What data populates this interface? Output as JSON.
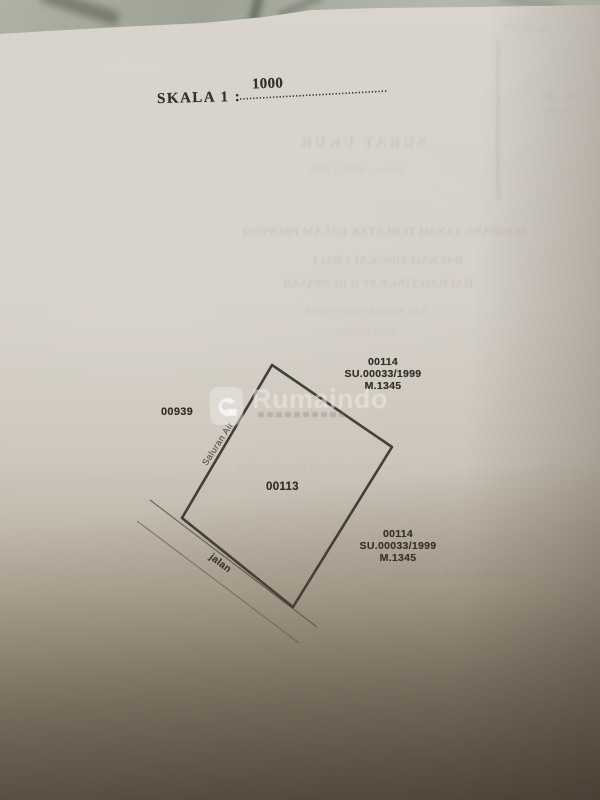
{
  "photo": {
    "surface": "marble-table",
    "colors": {
      "marble": "#a6aa9c",
      "paper_top": "#d8d4cd",
      "paper_bottom": "#6f6557",
      "ink": "#343028",
      "ghost_ink": "#7e756a",
      "watermark": "#f0ede8"
    }
  },
  "scale": {
    "label": "SKALA 1 :",
    "value": "1000"
  },
  "plan": {
    "parcel_number": "00113",
    "neighbor_left": "00939",
    "neighbor_top_right": {
      "l1": "00114",
      "l2": "SU.00033/1999",
      "l3": "M.1345"
    },
    "neighbor_bottom_right": {
      "l1": "00114",
      "l2": "SU.00033/1999",
      "l3": "M.1345"
    },
    "edge_labels": {
      "channel": "Saluran Air",
      "road": "jalan"
    }
  },
  "watermark": {
    "brand": "Rumaindo",
    "logo": "rumaindo-logo-icon"
  },
  "bleed_through_mirrored": {
    "g1": "SURAT UKUR",
    "g2": "Nomor : 00033 / 1999",
    "g3": "SEBIDANG TANAH TERLETAK DALAM PROPINSI",
    "g4": "DAERAH TINGKAT I BALI",
    "g5": "DAERAH TINGKAT II DENPASAR",
    "g6": "KECAMATAN DENPASAR",
    "g7": "KELURAHAN",
    "g8": "Sesuai Keputusan Kepala Kantor Pertanahan",
    "g9": "Pejabat Pembuat Akta Tanah",
    "g10": "tanggal 22 April 1999",
    "g11": "( Pasal 12 ayat 1 )",
    "g12": "No. 1810/B",
    "g13": "2962 / 1999",
    "g14": "20-03-1999"
  }
}
